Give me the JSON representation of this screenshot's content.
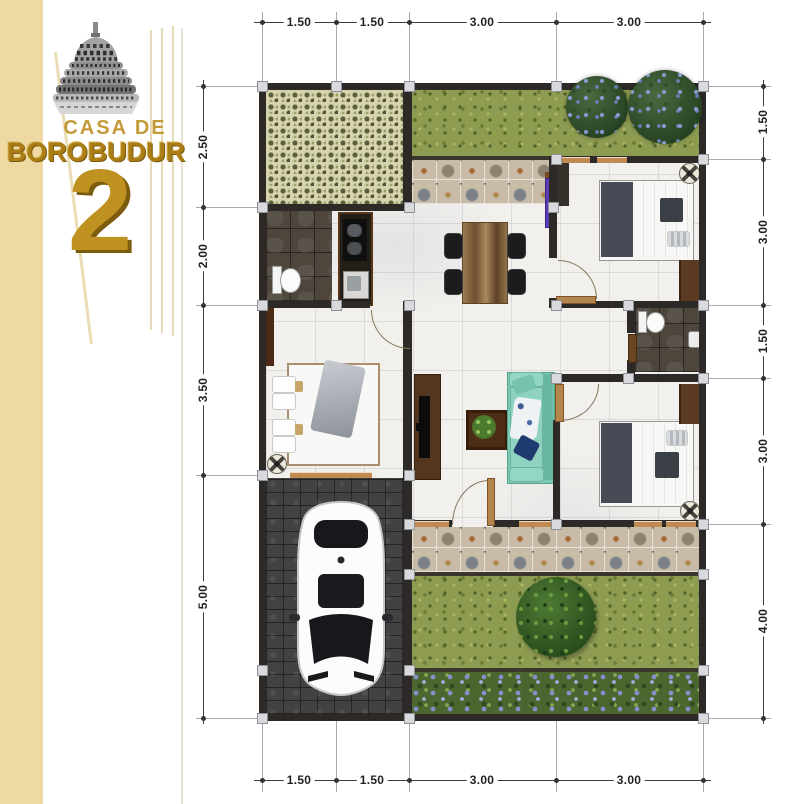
{
  "brand": {
    "line1": "CASA DE",
    "line2": "BOROBUDUR",
    "number": "2"
  },
  "dimensions": {
    "top": [
      "1.50",
      "1.50",
      "3.00",
      "3.00"
    ],
    "bottom": [
      "1.50",
      "1.50",
      "3.00",
      "3.00"
    ],
    "left": [
      "2.50",
      "2.00",
      "3.50",
      "5.00"
    ],
    "right": [
      "1.50",
      "3.00",
      "1.50",
      "3.00",
      "4.00"
    ]
  },
  "colors": {
    "brand_gold": "#b08418",
    "panel_cream": "#eed9a2",
    "wall": "#2c2926",
    "grass": "#8e9c52",
    "sofa_teal": "#7ec9b6",
    "floor": "#f1f0ed",
    "carport": "#424243",
    "deco_tile": "#c8bca9"
  },
  "icons": {
    "borobudur-stupa-icon": "grayscale temple stupa (svg)",
    "car-icon": "white car top view (svg)",
    "bed-icon": "double bed top view (css shapes)",
    "sofa-icon": "teal sofa with cushions (css shapes)",
    "dining-set-icon": "wood table with 4 black chairs (css shapes)",
    "toilet-icon": "toilet top view (css shapes)",
    "kitchen-counter-icon": "counter with cooktop and sink (css shapes)",
    "tv-console-icon": "tv cabinet (css shapes)",
    "plant-table-icon": "coffee table with plant (css shapes)",
    "ceiling-fan-icon": "fan cross in circle (css gradients)",
    "tree-icon": "round canopy (css circle)",
    "bush-icon": "shrub with blue flowers (css circle)",
    "wardrobe-icon": "dark wood strip (css rect)"
  }
}
